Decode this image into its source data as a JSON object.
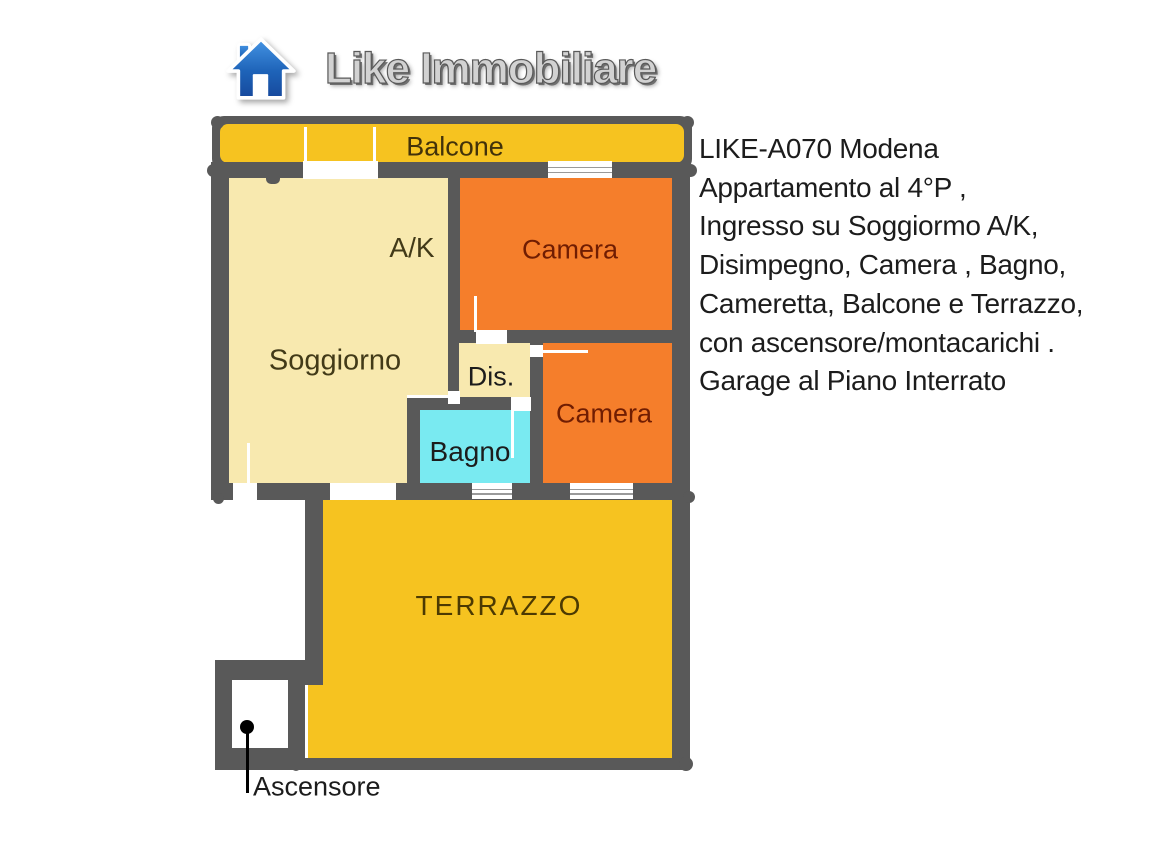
{
  "logo": {
    "brand": "Like Immobiliare",
    "icon": "house-icon"
  },
  "floorplan": {
    "labels": {
      "balcone": "Balcone",
      "soggiorno": "Soggiorno",
      "ak": "A/K",
      "camera_top": "Camera",
      "dis": "Dis.",
      "bagno": "Bagno",
      "camera_bottom": "Camera",
      "terrazzo": "TERRAZZO",
      "ascensore": "Ascensore"
    },
    "colors": {
      "wall": "#595959",
      "balcony_terrace_fill": "#F6C320",
      "living_fill": "#F8E9AF",
      "bedroom_fill": "#F57E2B",
      "bathroom_fill": "#79EAF1",
      "label_generic": "#423a18",
      "label_bedroom": "#701d02",
      "label_terrace": "#4c3a02",
      "logo_house_blue": "#1e63b8",
      "logo_text_gray": "#d2d2d2"
    }
  },
  "description": {
    "lines": [
      "LIKE-A070 Modena",
      "Appartamento al 4°P ,",
      "Ingresso su Soggiormo A/K,",
      "Disimpegno, Camera , Bagno,",
      "Cameretta, Balcone e Terrazzo,",
      "con ascensore/montacarichi .",
      "Garage al Piano Interrato"
    ]
  }
}
